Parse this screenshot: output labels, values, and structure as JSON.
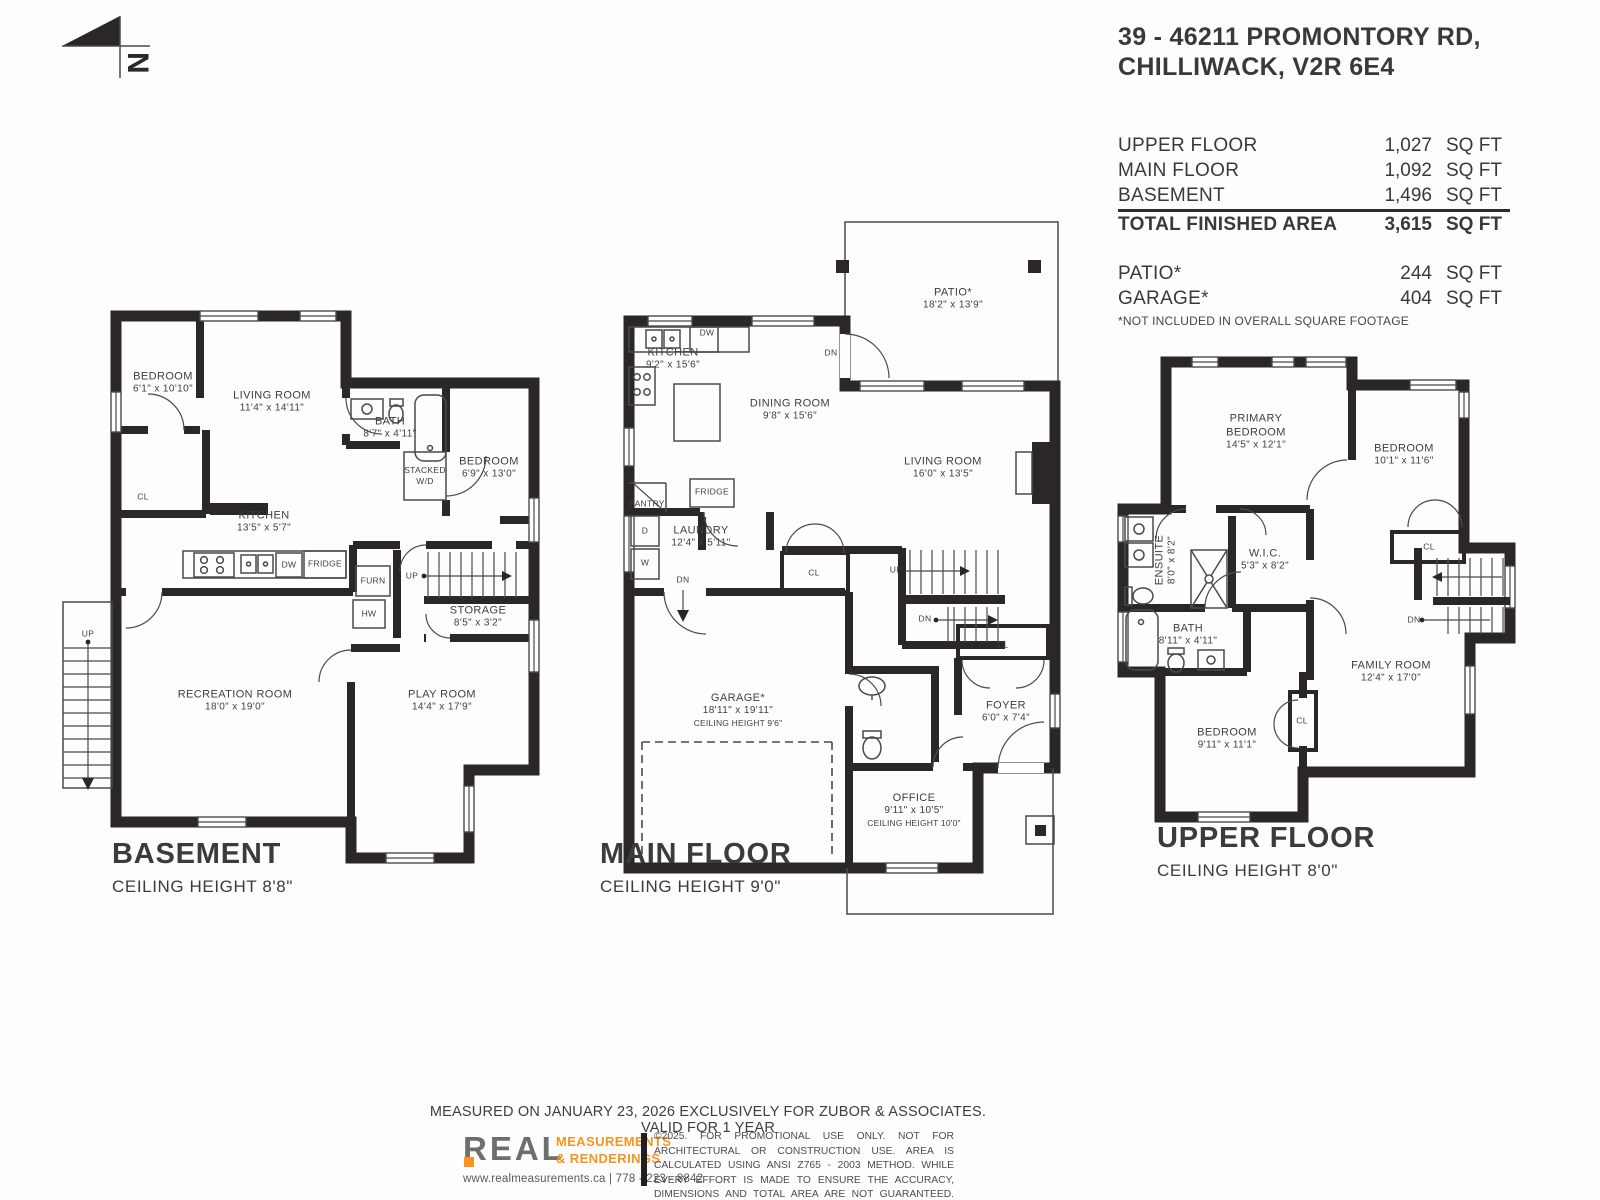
{
  "header": {
    "address_line1": "39 - 46211 PROMONTORY RD,",
    "address_line2": "CHILLIWACK, V2R 6E4",
    "north_letter": "N"
  },
  "area_summary": {
    "rows": [
      {
        "label": "UPPER FLOOR",
        "value": "1,027",
        "unit": "SQ FT"
      },
      {
        "label": "MAIN FLOOR",
        "value": "1,092",
        "unit": "SQ FT"
      },
      {
        "label": "BASEMENT",
        "value": "1,496",
        "unit": "SQ FT"
      }
    ],
    "total": {
      "label": "TOTAL FINISHED AREA",
      "value": "3,615",
      "unit": "SQ FT"
    },
    "extras": [
      {
        "label": "PATIO*",
        "value": "244",
        "unit": "SQ FT"
      },
      {
        "label": "GARAGE*",
        "value": "404",
        "unit": "SQ FT"
      }
    ],
    "footnote": "*NOT INCLUDED IN OVERALL SQUARE FOOTAGE"
  },
  "floors": {
    "basement": {
      "title": "BASEMENT",
      "ceiling": "CEILING HEIGHT 8'8\"",
      "labels": [
        {
          "lines": [
            "BEDROOM",
            "6'1\" x 10'10\""
          ],
          "x": 163,
          "y": 383,
          "kind": "room"
        },
        {
          "lines": [
            "LIVING ROOM",
            "11'4\" x 14'11\""
          ],
          "x": 272,
          "y": 402,
          "kind": "room"
        },
        {
          "lines": [
            "BATH",
            "8'7\" x 4'11\""
          ],
          "x": 390,
          "y": 428,
          "kind": "room"
        },
        {
          "lines": [
            "BEDROOM",
            "6'9\" x 13'0\""
          ],
          "x": 489,
          "y": 468,
          "kind": "room"
        },
        {
          "lines": [
            "CL"
          ],
          "x": 143,
          "y": 497,
          "kind": "small"
        },
        {
          "lines": [
            "STACKED",
            "W/D"
          ],
          "x": 425,
          "y": 476,
          "kind": "small"
        },
        {
          "lines": [
            "KITCHEN",
            "13'5\" x 5'7\""
          ],
          "x": 264,
          "y": 522,
          "kind": "room"
        },
        {
          "lines": [
            "DW"
          ],
          "x": 289,
          "y": 565,
          "kind": "small"
        },
        {
          "lines": [
            "FRIDGE"
          ],
          "x": 325,
          "y": 564,
          "kind": "small"
        },
        {
          "lines": [
            "FURN"
          ],
          "x": 373,
          "y": 581,
          "kind": "small"
        },
        {
          "lines": [
            "HW"
          ],
          "x": 369,
          "y": 614,
          "kind": "small"
        },
        {
          "lines": [
            "UP"
          ],
          "x": 412,
          "y": 576,
          "kind": "small"
        },
        {
          "lines": [
            "STORAGE",
            "8'5\" x 3'2\""
          ],
          "x": 478,
          "y": 617,
          "kind": "room"
        },
        {
          "lines": [
            "UP"
          ],
          "x": 88,
          "y": 634,
          "kind": "small"
        },
        {
          "lines": [
            "RECREATION ROOM",
            "18'0\" x 19'0\""
          ],
          "x": 235,
          "y": 701,
          "kind": "room"
        },
        {
          "lines": [
            "PLAY ROOM",
            "14'4\" x 17'9\""
          ],
          "x": 442,
          "y": 701,
          "kind": "room"
        }
      ]
    },
    "main": {
      "title": "MAIN FLOOR",
      "ceiling": "CEILING HEIGHT 9'0\"",
      "labels": [
        {
          "lines": [
            "PATIO*",
            "18'2\" x 13'9\""
          ],
          "x": 953,
          "y": 299,
          "kind": "room"
        },
        {
          "lines": [
            "KITCHEN",
            "9'2\" x 15'6\""
          ],
          "x": 673,
          "y": 359,
          "kind": "room"
        },
        {
          "lines": [
            "DW"
          ],
          "x": 707,
          "y": 333,
          "kind": "small"
        },
        {
          "lines": [
            "DN"
          ],
          "x": 831,
          "y": 353,
          "kind": "small"
        },
        {
          "lines": [
            "DINING ROOM",
            "9'8\" x 15'6\""
          ],
          "x": 790,
          "y": 410,
          "kind": "room"
        },
        {
          "lines": [
            "LIVING ROOM",
            "16'0\" x 13'5\""
          ],
          "x": 943,
          "y": 468,
          "kind": "room"
        },
        {
          "lines": [
            "PANTRY"
          ],
          "x": 647,
          "y": 504,
          "kind": "small"
        },
        {
          "lines": [
            "FRIDGE"
          ],
          "x": 712,
          "y": 492,
          "kind": "small"
        },
        {
          "lines": [
            "LAUNDRY",
            "12'4\" x 5'11\""
          ],
          "x": 701,
          "y": 537,
          "kind": "room"
        },
        {
          "lines": [
            "D"
          ],
          "x": 645,
          "y": 531,
          "kind": "small"
        },
        {
          "lines": [
            "W"
          ],
          "x": 645,
          "y": 563,
          "kind": "small"
        },
        {
          "lines": [
            "DN"
          ],
          "x": 683,
          "y": 580,
          "kind": "small"
        },
        {
          "lines": [
            "CL"
          ],
          "x": 814,
          "y": 573,
          "kind": "small"
        },
        {
          "lines": [
            "UP"
          ],
          "x": 896,
          "y": 570,
          "kind": "small"
        },
        {
          "lines": [
            "DN"
          ],
          "x": 925,
          "y": 619,
          "kind": "small"
        },
        {
          "lines": [
            "GARAGE*",
            "18'11\" x 19'11\"",
            "CEILING HEIGHT 9'6\""
          ],
          "x": 738,
          "y": 710,
          "kind": "room"
        },
        {
          "lines": [
            "CL"
          ],
          "x": 1003,
          "y": 645,
          "kind": "small"
        },
        {
          "lines": [
            "FOYER",
            "6'0\" x 7'4\""
          ],
          "x": 1006,
          "y": 712,
          "kind": "room"
        },
        {
          "lines": [
            "OFFICE",
            "9'11\" x 10'5\"",
            "CEILING HEIGHT 10'0\""
          ],
          "x": 914,
          "y": 810,
          "kind": "room"
        }
      ]
    },
    "upper": {
      "title": "UPPER FLOOR",
      "ceiling": "CEILING HEIGHT 8'0\"",
      "labels": [
        {
          "lines": [
            "PRIMARY",
            "BEDROOM",
            "14'5\" x 12'1\""
          ],
          "x": 1256,
          "y": 432,
          "kind": "room"
        },
        {
          "lines": [
            "BEDROOM",
            "10'1\" x 11'6\""
          ],
          "x": 1404,
          "y": 455,
          "kind": "room"
        },
        {
          "lines": [
            "ENSUITE",
            "8'0\" x 8'2\""
          ],
          "x": 1166,
          "y": 560,
          "kind": "vertical"
        },
        {
          "lines": [
            "W.I.C.",
            "5'3\" x 8'2\""
          ],
          "x": 1265,
          "y": 560,
          "kind": "room"
        },
        {
          "lines": [
            "CL"
          ],
          "x": 1429,
          "y": 547,
          "kind": "small"
        },
        {
          "lines": [
            "BATH",
            "8'11\" x 4'11\""
          ],
          "x": 1188,
          "y": 635,
          "kind": "room"
        },
        {
          "lines": [
            "DN"
          ],
          "x": 1414,
          "y": 620,
          "kind": "small"
        },
        {
          "lines": [
            "FAMILY ROOM",
            "12'4\" x 17'0\""
          ],
          "x": 1391,
          "y": 672,
          "kind": "room"
        },
        {
          "lines": [
            "CL"
          ],
          "x": 1302,
          "y": 721,
          "kind": "small"
        },
        {
          "lines": [
            "BEDROOM",
            "9'11\" x 11'1\""
          ],
          "x": 1227,
          "y": 739,
          "kind": "room"
        }
      ]
    }
  },
  "footer": {
    "measured_line": "MEASURED ON JANUARY 23, 2026 EXCLUSIVELY FOR ZUBOR & ASSOCIATES. VALID FOR 1 YEAR",
    "logo_word": "REAL",
    "logo_line1": "MEASUREMENTS",
    "logo_line2": "& RENDERINGS",
    "website_phone": "www.realmeasurements.ca | 778 - 223 - 8842",
    "disclaimer": "©2025. FOR PROMOTIONAL USE ONLY. NOT FOR ARCHITECTURAL OR CONSTRUCTION USE. AREA IS CALCULATED USING ANSI Z765 - 2003 METHOD. WHILE EVERY EFFORT IS MADE TO ENSURE THE ACCURACY, DIMENSIONS AND TOTAL AREA ARE NOT GUARANTEED. TOTAL AREA MAY INCLUDE SOME UNFINISHED OR UNDER HEIGHT AREA."
  }
}
